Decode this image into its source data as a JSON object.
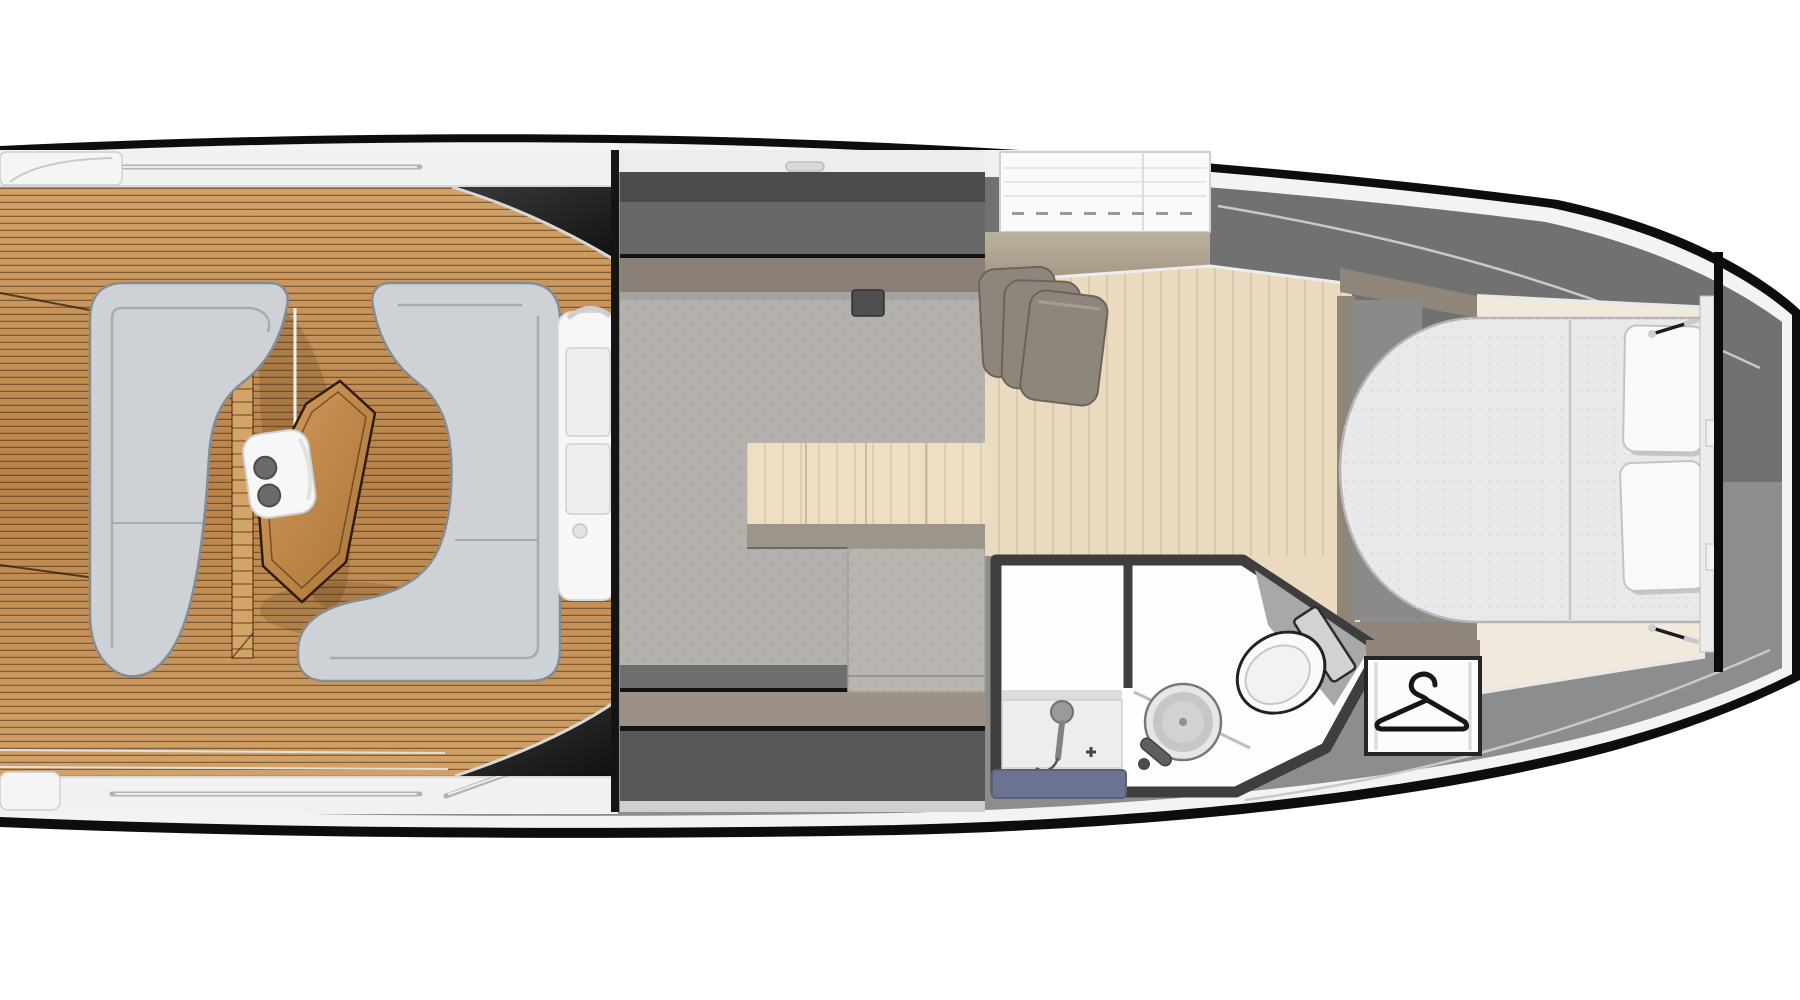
{
  "meta": {
    "title": "Motor yacht interior floor plan — top view",
    "view": "top-down deck plan, bow to the right, stern to the left (cropped at both image edges)"
  },
  "icons": [
    {
      "name": "hanger-icon",
      "meaning": "wardrobe / hanging locker symbol"
    }
  ],
  "areas": {
    "cockpit": {
      "name": "aft cockpit",
      "features": [
        "teak deck planking",
        "port C-shaped sofa",
        "starboard J-shaped sofa",
        "teak cocktail table",
        "folding seat with cupholders",
        "side grab rails",
        "windshield frame"
      ]
    },
    "salon": {
      "name": "main salon",
      "features": [
        "grey cabin sole",
        "sideboard cabinet",
        "mid-cabin berth below"
      ]
    },
    "mid_cabin": {
      "name": "mid cabin entry",
      "features": [
        "overhead hatch",
        "stacked cushions",
        "light wood sole"
      ]
    },
    "bathroom": {
      "name": "head compartment",
      "features": [
        "shower stall with hand shower",
        "blue shower grate",
        "round wash basin",
        "angled toilet"
      ]
    },
    "wardrobe": {
      "name": "hanging locker",
      "icon": "hanger-icon"
    },
    "bow_cabin": {
      "name": "forward cabin",
      "features": [
        "island double berth",
        "two pillows",
        "center mattress seam",
        "gas struts",
        "marble side sole strips"
      ]
    },
    "foredeck": {
      "name": "foredeck",
      "features": [
        "two-tone grey deck",
        "collision bulkhead line"
      ]
    }
  },
  "colors": {
    "background": "#ffffff",
    "hull_outline": "#0d0d0d",
    "hull_band": "#f3f3f3",
    "deck_gray": "#8d8d8d",
    "deck_gray_dark": "#717171",
    "trim_light": "#c9c9c9",
    "gunwale_white": "#f1f1f1",
    "rail_metal": "#b3b3b3",
    "rail_metal_hi": "#ececec",
    "teak_light": "#d2a268",
    "teak_dark": "#b8834a",
    "sofa": "#ced2d6",
    "sofa_border": "#878c91",
    "sofa_seam": "#a6abb0",
    "table_wood": "#c8914f",
    "table_border": "#2e1d0c",
    "windshield_dark": "#2a2a2a",
    "module_white": "#f7f7f7",
    "salon_band_dark": "#4c4c4c",
    "salon_band_mid": "#686868",
    "salon_band_brown": "#8a8078",
    "salon_band_taupe": "#9b9187",
    "salon_band_deep": "#575757",
    "line_black": "#141414",
    "salon_floor": "#b4b1ac",
    "cabinet_cream": "#ecdfc4",
    "cabinet_seam": "#bfae8e",
    "cabinet_gray": "#9b958c",
    "berth_gray": "#b8b4af",
    "hatch_white": "#fafafa",
    "hatch_dash": "#9a9a9a",
    "tan_band": "#b0a492",
    "cabin_floor": "#eadabf",
    "cushion": "#8e867c",
    "cushion_border": "#6b645b",
    "taupe_cabinet": "#8f8579",
    "marble": "#f1eadc",
    "mattress": "#e9e9eb",
    "mattress_border": "#b4b4b7",
    "mattress_seam": "#c6c6c8",
    "pillow": "#f9f9f9",
    "pillow_border": "#c3c3c3",
    "bed_trim": "#ececec",
    "bulkhead": "#0c0c0c",
    "bath_wall": "#3e3e3e",
    "bath_floor": "#fdfdfd",
    "shower_tray": "#ededed",
    "mat_blue": "#6b7390",
    "mat_blue_border": "#59617c",
    "sink_outer": "#e6e6e6",
    "sink_mid": "#c6c6c6",
    "sink_inner": "#d2d2d2",
    "sink_ring": "#777777",
    "faucet": "#5f5f5f",
    "toilet_white": "#fafafa",
    "toilet_border": "#222222",
    "toilet_tank": "#d2d2d2",
    "toilet_shadow": "#a8a8a8",
    "wardrobe_white": "#fcfcfc",
    "wardrobe_border": "#262626",
    "hanger": "#161616",
    "strut": "#1c1c1c",
    "step_white": "#f5f5f5"
  }
}
